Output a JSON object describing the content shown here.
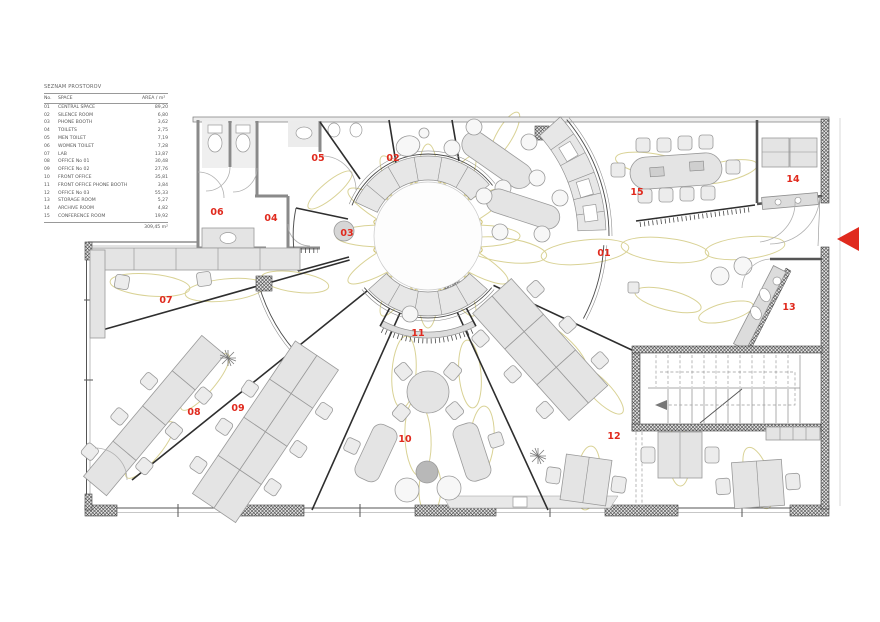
{
  "colors": {
    "accent_red": "#e02a1e",
    "flower": "#d9d295",
    "flower_center": "#cdbf6a"
  },
  "legend": {
    "title": "SEZNAM PROSTOROV",
    "columns": {
      "no": "No.",
      "space": "SPACE",
      "area": "AREA / m²"
    },
    "rows": [
      {
        "no": "01",
        "space": "CENTRAL SPACE",
        "area": "89,20"
      },
      {
        "no": "02",
        "space": "SILENCE ROOM",
        "area": "6,80"
      },
      {
        "no": "03",
        "space": "PHONE BOOTH",
        "area": "3,62"
      },
      {
        "no": "04",
        "space": "TOILETS",
        "area": "2,75"
      },
      {
        "no": "05",
        "space": "MEN TOILET",
        "area": "7,19"
      },
      {
        "no": "06",
        "space": "WOMEN TOILET",
        "area": "7,28"
      },
      {
        "no": "07",
        "space": "LAB",
        "area": "13,87"
      },
      {
        "no": "08",
        "space": "OFFICE No 01",
        "area": "30,48"
      },
      {
        "no": "09",
        "space": "OFFICE No 02",
        "area": "27,76"
      },
      {
        "no": "10",
        "space": "FRONT OFFICE",
        "area": "35,81"
      },
      {
        "no": "11",
        "space": "FRONT OFFICE PHONE BOOTH",
        "area": "3,84"
      },
      {
        "no": "12",
        "space": "OFFICE No 03",
        "area": "55,33"
      },
      {
        "no": "13",
        "space": "STORAGE ROOM",
        "area": "5,27"
      },
      {
        "no": "14",
        "space": "ARCHIVE ROOM",
        "area": "4,82"
      },
      {
        "no": "15",
        "space": "CONFERENCE ROOM",
        "area": "19,92"
      }
    ],
    "total": "309,45 m²"
  },
  "plan": {
    "labels": {
      "r01": "01",
      "r02": "02",
      "r03": "03",
      "r04": "04",
      "r05": "05",
      "r06": "06",
      "r07": "07",
      "r08": "08",
      "r09": "09",
      "r10": "10",
      "r11": "11",
      "r12": "12",
      "r13": "13",
      "r14": "14",
      "r15": "15"
    }
  }
}
